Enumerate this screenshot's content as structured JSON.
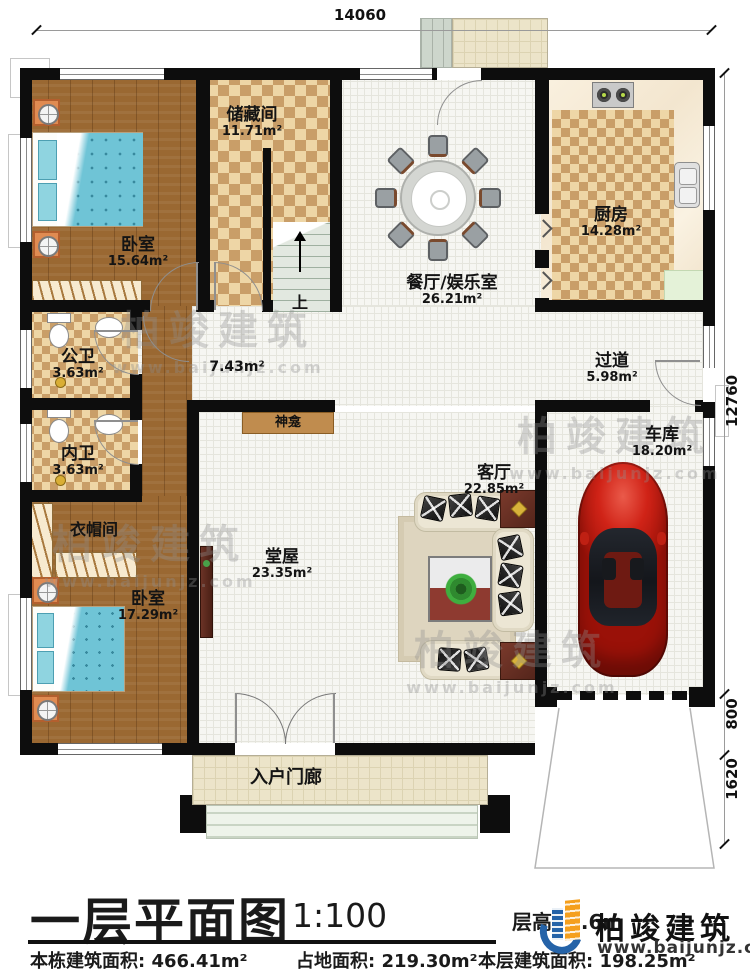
{
  "plan": {
    "dim_top": "14060",
    "dim_right_upper": "12760",
    "dim_right_mid": "800",
    "dim_right_lower": "1620",
    "stairs_label": "上",
    "watermark": {
      "name": "柏竣建筑",
      "url": "www.baijunjz.com"
    },
    "rooms": {
      "bedroom1": {
        "name": "卧室",
        "area": "15.64m²"
      },
      "storage": {
        "name": "储藏间",
        "area": "11.71m²"
      },
      "dining": {
        "name": "餐厅/娱乐室",
        "area": "26.21m²"
      },
      "kitchen": {
        "name": "厨房",
        "area": "14.28m²"
      },
      "corridor": {
        "area": "7.43m²"
      },
      "hallway": {
        "name": "过道",
        "area": "5.98m²"
      },
      "public_bath": {
        "name": "公卫",
        "area": "3.63m²"
      },
      "inner_bath": {
        "name": "内卫",
        "area": "3.63m²"
      },
      "cloakroom": {
        "name": "衣帽间"
      },
      "bedroom2": {
        "name": "卧室",
        "area": "17.29m²"
      },
      "main_hall": {
        "name": "堂屋",
        "area": "23.35m²"
      },
      "living": {
        "name": "客厅",
        "area": "22.85m²"
      },
      "garage": {
        "name": "车库",
        "area": "18.20m²"
      },
      "entry_porch": {
        "name": "入户门廊"
      },
      "shrine": {
        "name": "神龛"
      }
    }
  },
  "title_block": {
    "title": "一层平面图",
    "scale": "1:100",
    "floor_height": "层高: 3.6m",
    "building_total_area": "本栋建筑面积: 466.41m²",
    "land_area": "占地面积: 219.30m²",
    "floor_area": "本层建筑面积: 198.25m²",
    "logo": {
      "name": "柏竣建筑",
      "url": "www.baijunjz.com"
    }
  },
  "colors": {
    "logo_blue": "#2563a8",
    "logo_orange": "#f59f1d",
    "car_red": "#c92014",
    "wall": "#0d0d0d"
  }
}
